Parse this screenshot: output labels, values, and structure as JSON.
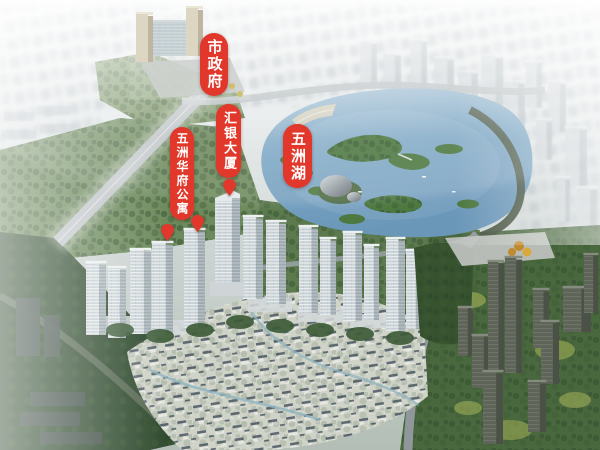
{
  "labels": [
    {
      "id": "city-government",
      "text": "市政府",
      "x": 200,
      "y": 33,
      "w": 28,
      "h": 63,
      "font_px": 15
    },
    {
      "id": "huiyin-tower",
      "text": "汇银大厦",
      "x": 216,
      "y": 104,
      "w": 25,
      "h": 74,
      "font_px": 13
    },
    {
      "id": "wuzhou-lake",
      "text": "五洲湖",
      "x": 283,
      "y": 124,
      "w": 29,
      "h": 64,
      "font_px": 15
    },
    {
      "id": "wuzhou-huafu-apartments",
      "text": "五洲华府公寓",
      "x": 170,
      "y": 127,
      "w": 24,
      "h": 93,
      "font_px": 12
    }
  ],
  "markers": [
    {
      "id": "pin-huafu-west-tower",
      "x": 167,
      "y": 241
    },
    {
      "id": "pin-huafu-east-tower",
      "x": 197,
      "y": 232
    },
    {
      "id": "pin-huiyin-tower",
      "x": 229,
      "y": 196
    }
  ],
  "colors": {
    "label_bg": "#e1382b",
    "label_text": "#ffffff",
    "pin": "#e1382b",
    "lake": "#7ba6c4",
    "island": "#4d7840",
    "tree_dark": "#31492f",
    "haze": "#f2f4f4"
  }
}
